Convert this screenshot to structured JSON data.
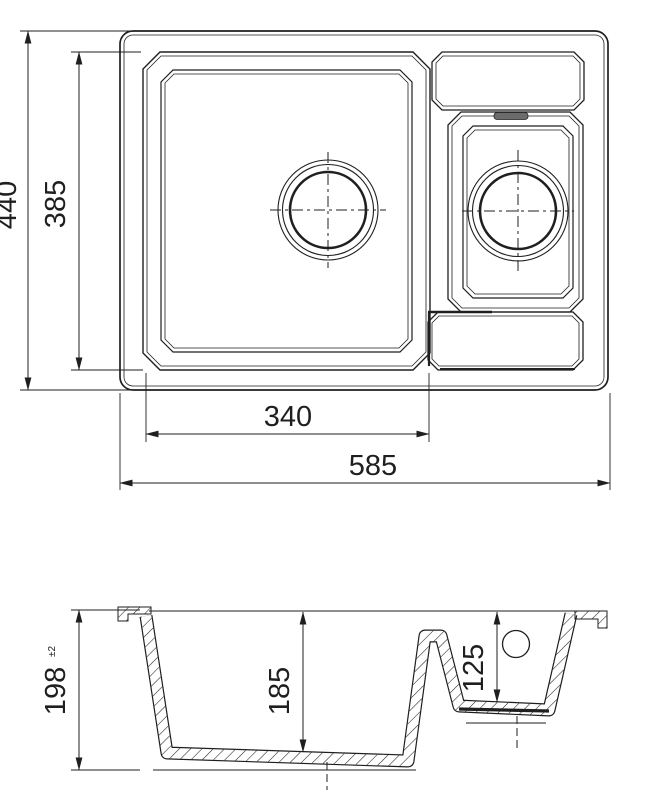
{
  "drawing": {
    "kind": "technical-dimension-drawing",
    "subject": "one-and-half-bowl-sink"
  },
  "top_view": {
    "dim_overall_depth": "440",
    "dim_bowl_outline_depth": "385",
    "dim_main_bowl_width": "340",
    "dim_overall_width": "585"
  },
  "section_view": {
    "dim_overall_height": "198",
    "dim_overall_height_tolerance": "±2",
    "dim_main_bowl_depth": "185",
    "dim_small_bowl_depth": "125"
  },
  "colors": {
    "line": "#1f1f1f",
    "background": "#ffffff",
    "slot_fill": "#6b6b6b"
  }
}
